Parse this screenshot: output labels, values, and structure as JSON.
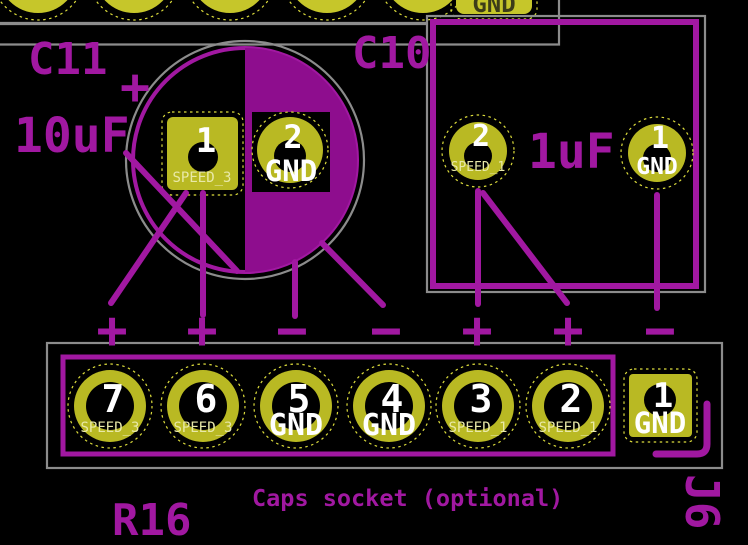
{
  "board": {
    "c11": {
      "ref": "C11",
      "value": "10uF",
      "polarity_mark": "+",
      "pads": [
        {
          "number": "1",
          "net": "SPEED_3"
        },
        {
          "number": "2",
          "net": "GND"
        }
      ]
    },
    "c10": {
      "ref": "C10",
      "value": "1uF",
      "pads": [
        {
          "number": "2",
          "net": "SPEED_1"
        },
        {
          "number": "1",
          "net": "GND"
        }
      ]
    },
    "socket": {
      "caption": "Caps socket (optional)",
      "pads": [
        {
          "number": "7",
          "net": "SPEED_3",
          "polarity": "+"
        },
        {
          "number": "6",
          "net": "SPEED_3",
          "polarity": "+"
        },
        {
          "number": "5",
          "net": "GND",
          "polarity": "−"
        },
        {
          "number": "4",
          "net": "GND",
          "polarity": "−"
        },
        {
          "number": "3",
          "net": "SPEED_1",
          "polarity": "+"
        },
        {
          "number": "2",
          "net": "SPEED_1",
          "polarity": "+"
        },
        {
          "number": "1",
          "net": "GND",
          "polarity": "−"
        }
      ]
    },
    "r16": {
      "ref": "R16"
    },
    "j6": {
      "ref": "J6"
    },
    "top_connector": {
      "gnd_pad_label": "GND"
    },
    "colors": {
      "silkscreen_purple": "#A118A1",
      "silkscreen_fill": "#8E0D8E",
      "courtyard_gray": "#8C8C8C",
      "pad_yellow": "#B9B923",
      "top_pad_yellow": "#C6C62A",
      "clearance_yellow": "#DCDC3C",
      "net_label_pale": "#E9E9A8",
      "pad_number_white": "#FFFFFF",
      "background": "#000000"
    }
  }
}
